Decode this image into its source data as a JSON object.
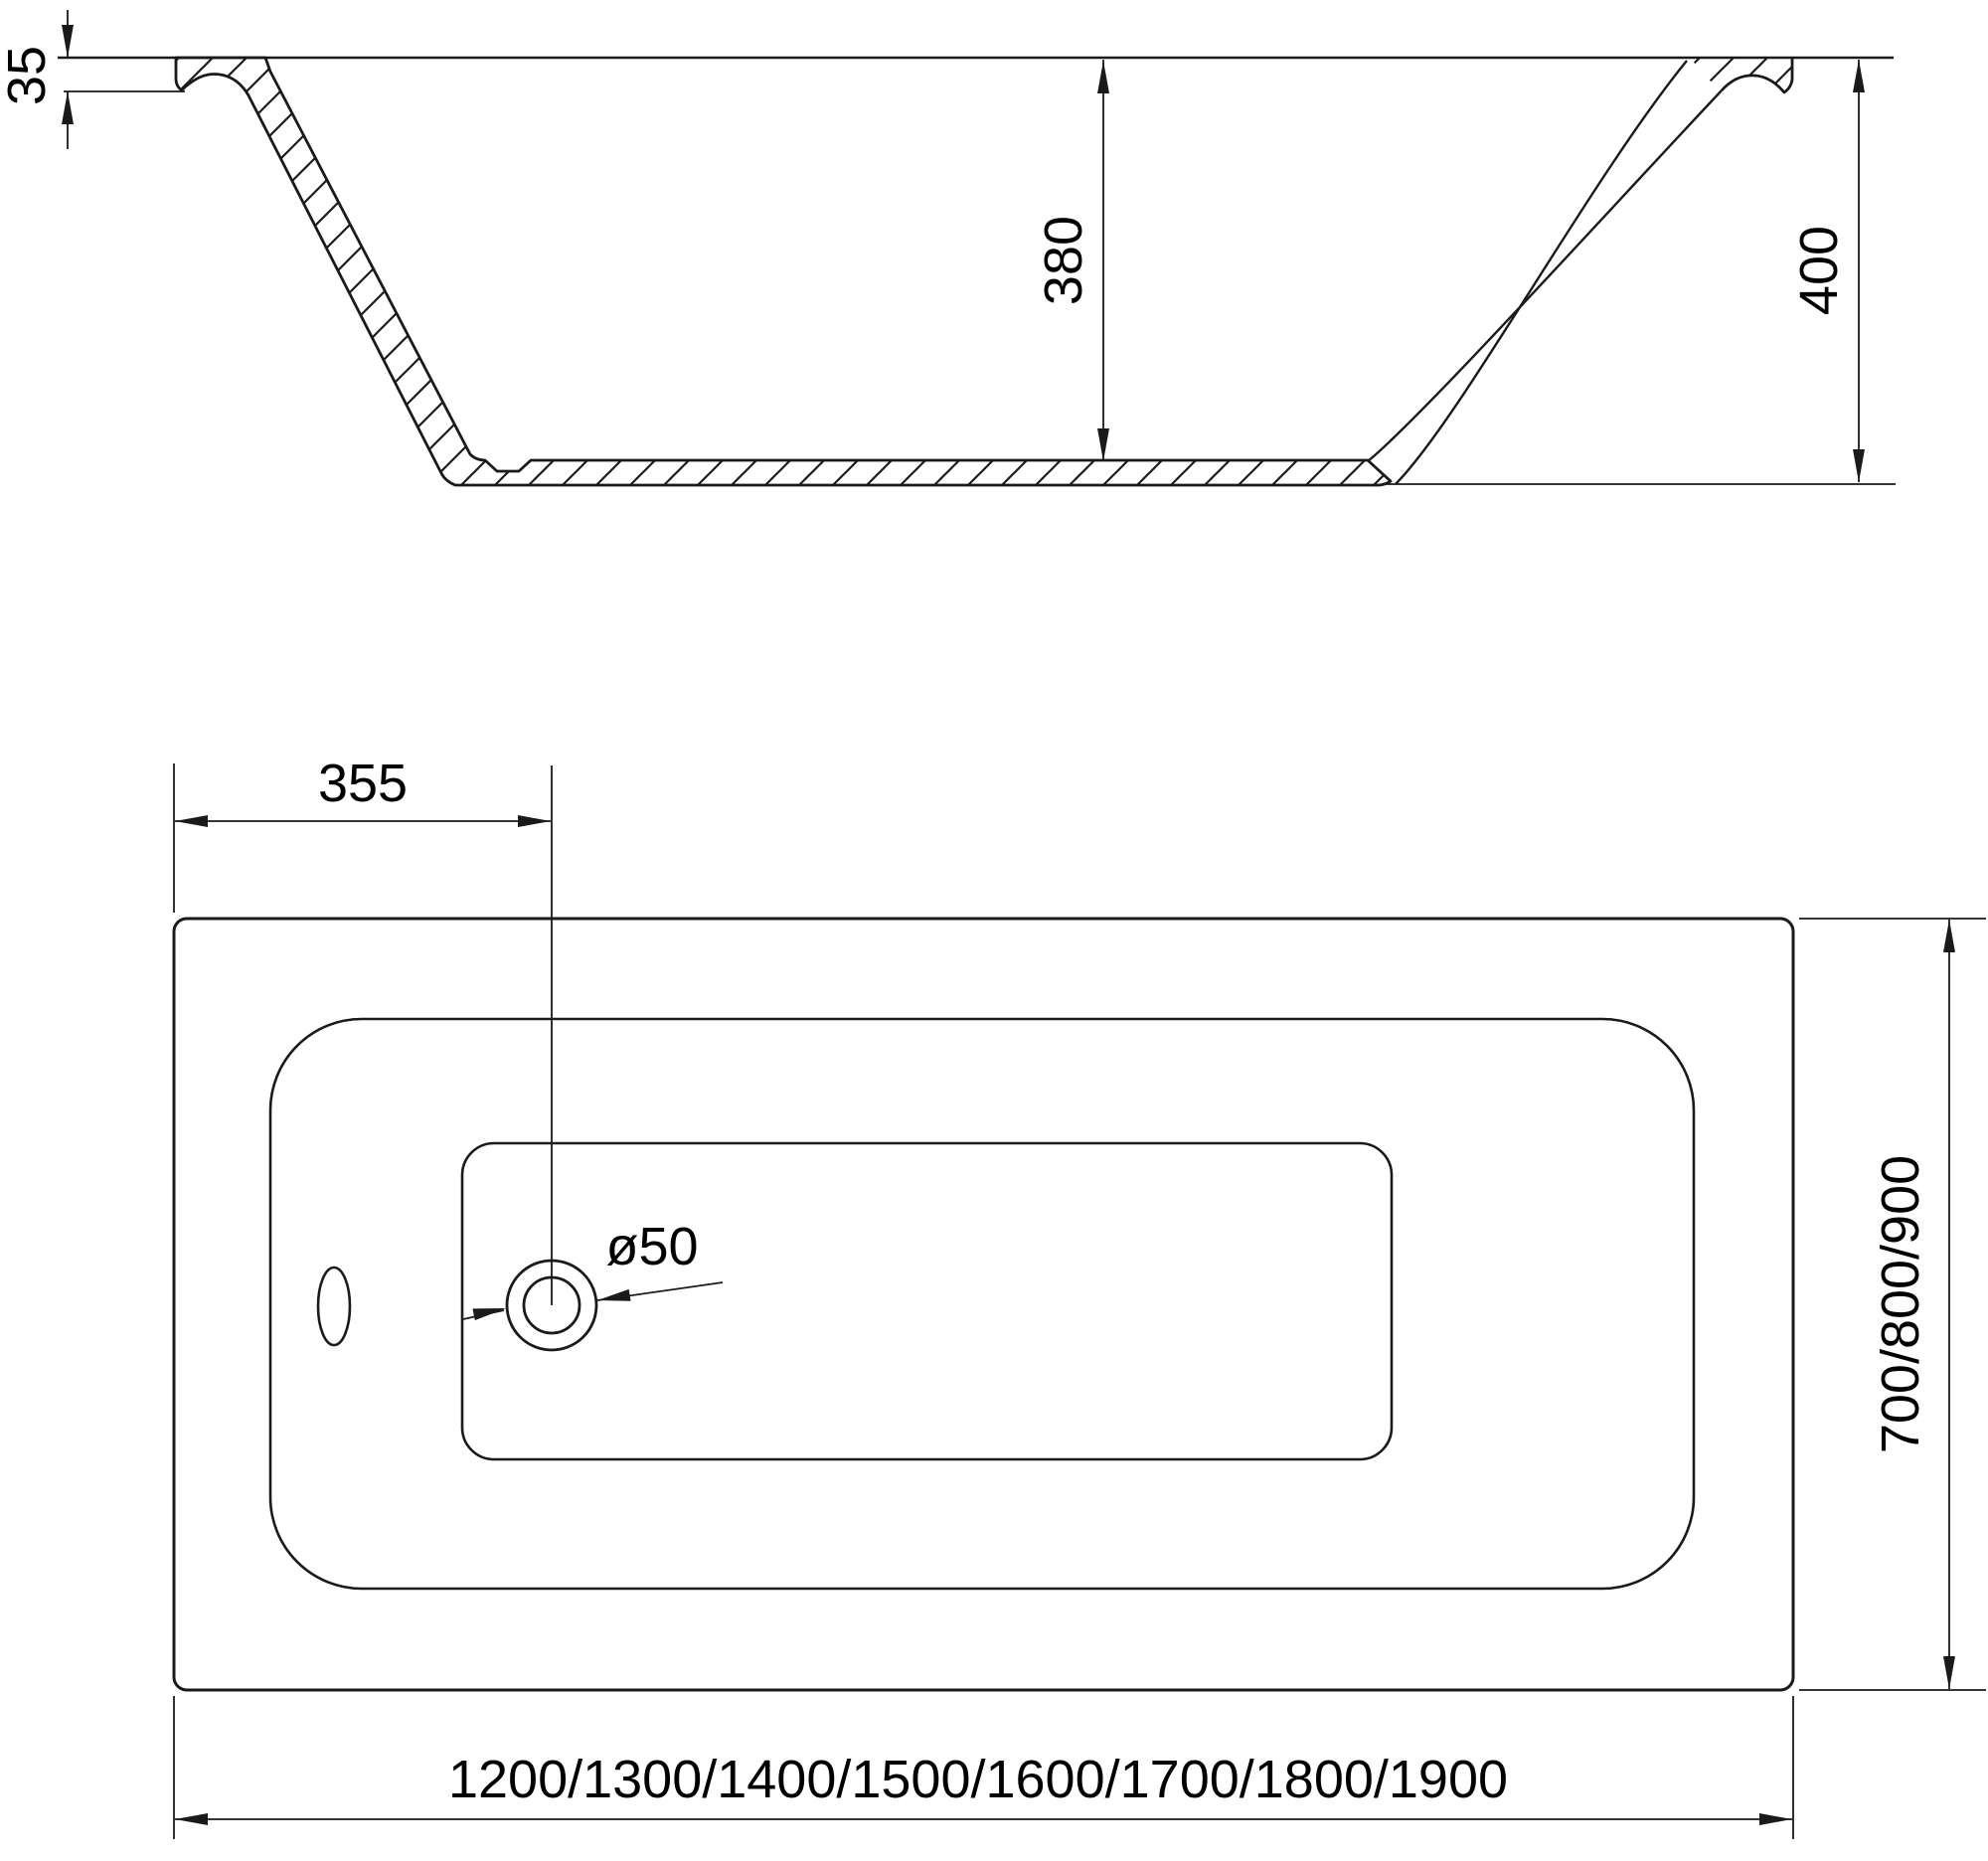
{
  "drawing": {
    "colors": {
      "line": "#1a1a1a",
      "background": "#ffffff",
      "text": "#000000"
    },
    "side_view": {
      "rim_thickness": "35",
      "inner_depth": "380",
      "overall_height": "400"
    },
    "plan_view": {
      "drain_offset": "355",
      "drain_diameter": "ø50",
      "length_options": "1200/1300/1400/1500/1600/1700/1800/1900",
      "width_options": "700/800/900"
    }
  }
}
